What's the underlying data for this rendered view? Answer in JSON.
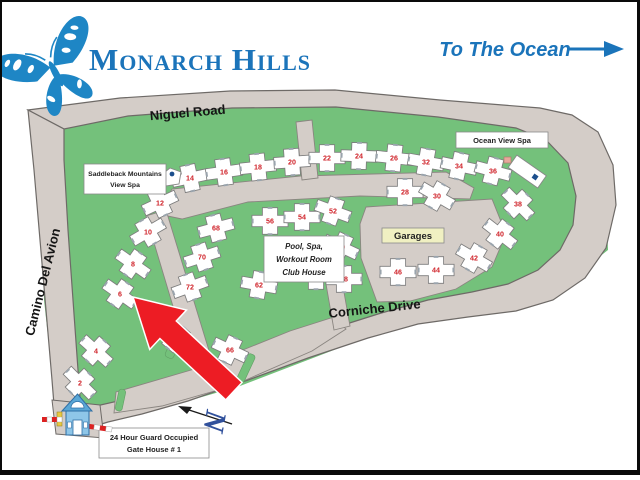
{
  "title": "Monarch Hills",
  "ocean": {
    "label": "To The Ocean"
  },
  "roads": {
    "niguel": "Niguel Road",
    "camino": "Camino Del Avion",
    "corniche": "Corniche Drive"
  },
  "amenities": {
    "saddleback_spa_line1": "Saddleback Mountains",
    "saddleback_spa_line2": "View Spa",
    "ocean_spa": "Ocean View Spa",
    "clubhouse_line1": "Pool, Spa,",
    "clubhouse_line2": "Workout Room",
    "clubhouse_line3": "Club House",
    "garages": "Garages",
    "gatehouse_line1": "24 Hour Guard Occupied",
    "gatehouse_line2": "Gate House # 1"
  },
  "compass": {
    "label": "N"
  },
  "colors": {
    "grass": "#74c17b",
    "road": "#d4cdc8",
    "road_edge": "#6e6a67",
    "accent_blue": "#1b74ba",
    "butterfly_blue": "#1e86c5",
    "building_fill": "#ffffff",
    "building_edge": "#7d7d7d",
    "building_number_red": "#cf2027",
    "arrow_red": "#ed1c24",
    "garage_fill": "#f0f0c2",
    "clubhouse_pink": "#f6b9ab",
    "pool_blue": "#2f6db5",
    "compass_blue": "#31519c"
  },
  "buildings": [
    {
      "num": "14",
      "x": 190,
      "y": 178,
      "r": -12
    },
    {
      "num": "16",
      "x": 224,
      "y": 172,
      "r": -8
    },
    {
      "num": "18",
      "x": 258,
      "y": 167,
      "r": -6
    },
    {
      "num": "20",
      "x": 292,
      "y": 162,
      "r": -4
    },
    {
      "num": "22",
      "x": 327,
      "y": 158,
      "r": 0
    },
    {
      "num": "24",
      "x": 359,
      "y": 156,
      "r": 2
    },
    {
      "num": "26",
      "x": 394,
      "y": 158,
      "r": 6
    },
    {
      "num": "32",
      "x": 426,
      "y": 162,
      "r": 10
    },
    {
      "num": "34",
      "x": 459,
      "y": 166,
      "r": 12
    },
    {
      "num": "36",
      "x": 493,
      "y": 171,
      "r": 15
    },
    {
      "num": "28",
      "x": 405,
      "y": 192,
      "r": 0
    },
    {
      "num": "30",
      "x": 437,
      "y": 196,
      "r": 30
    },
    {
      "num": "12",
      "x": 160,
      "y": 203,
      "r": -25
    },
    {
      "num": "10",
      "x": 148,
      "y": 232,
      "r": -30
    },
    {
      "num": "8",
      "x": 133,
      "y": 264,
      "r": 35
    },
    {
      "num": "6",
      "x": 120,
      "y": 294,
      "r": 35
    },
    {
      "num": "4",
      "x": 96,
      "y": 351,
      "r": 42
    },
    {
      "num": "2",
      "x": 80,
      "y": 383,
      "r": 45
    },
    {
      "num": "68",
      "x": 216,
      "y": 228,
      "r": -15
    },
    {
      "num": "70",
      "x": 202,
      "y": 257,
      "r": -18
    },
    {
      "num": "72",
      "x": 190,
      "y": 287,
      "r": -20
    },
    {
      "num": "56",
      "x": 270,
      "y": 221,
      "r": 0
    },
    {
      "num": "54",
      "x": 302,
      "y": 217,
      "r": 0
    },
    {
      "num": "52",
      "x": 333,
      "y": 211,
      "r": 20
    },
    {
      "num": "50",
      "x": 341,
      "y": 247,
      "r": 25
    },
    {
      "num": "60",
      "x": 316,
      "y": 276,
      "r": 0
    },
    {
      "num": "48",
      "x": 344,
      "y": 279,
      "r": 0
    },
    {
      "num": "62",
      "x": 259,
      "y": 285,
      "r": 10
    },
    {
      "num": "64",
      "x": 176,
      "y": 338,
      "r": 40
    },
    {
      "num": "66",
      "x": 230,
      "y": 350,
      "r": 25
    },
    {
      "num": "46",
      "x": 398,
      "y": 272,
      "r": 0
    },
    {
      "num": "44",
      "x": 436,
      "y": 270,
      "r": 0
    },
    {
      "num": "42",
      "x": 474,
      "y": 258,
      "r": 30
    },
    {
      "num": "40",
      "x": 500,
      "y": 234,
      "r": 38
    },
    {
      "num": "38",
      "x": 518,
      "y": 204,
      "r": 45
    }
  ]
}
